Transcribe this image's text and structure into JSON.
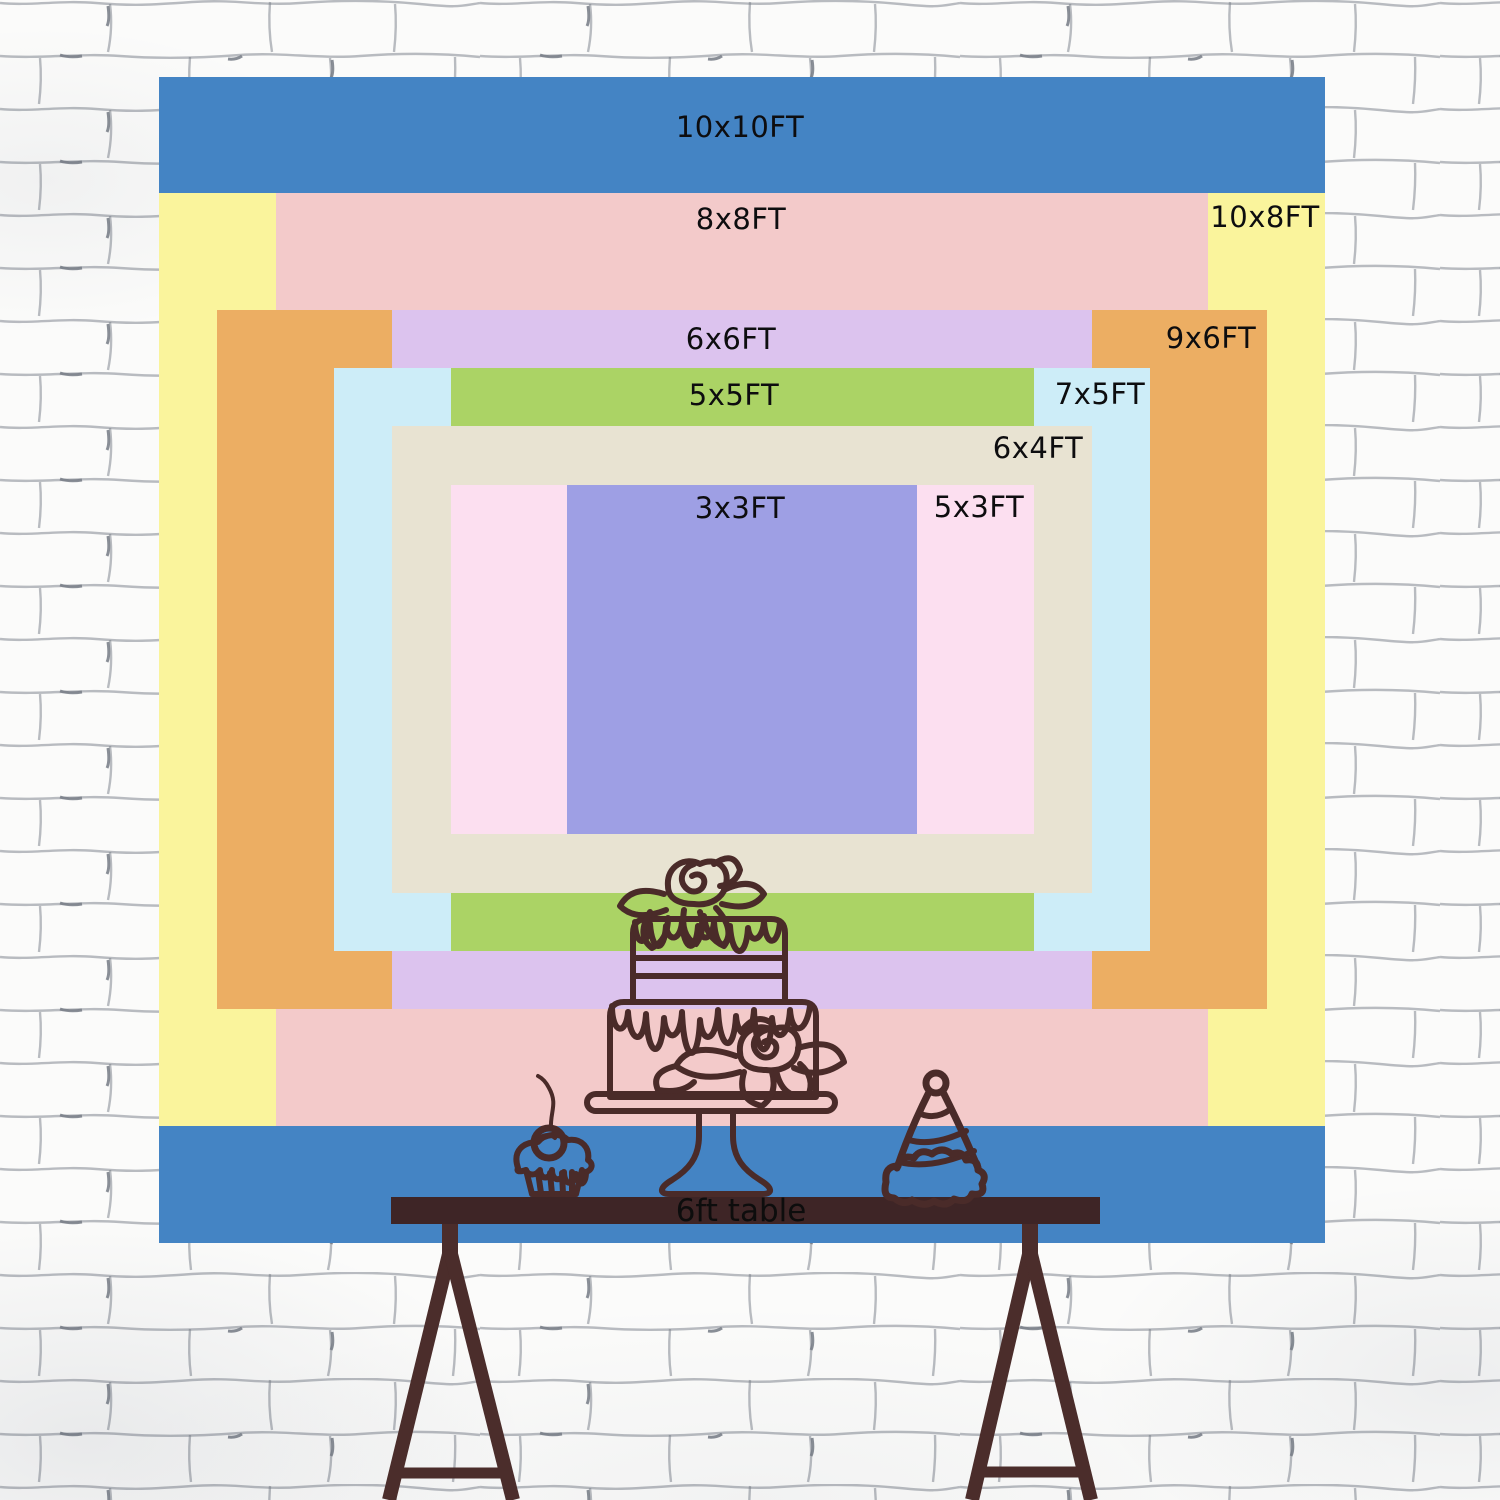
{
  "scene": {
    "wall_color": "#fbfbfa",
    "mortar_color": "#767b85"
  },
  "backdrop": {
    "px_per_ft": 116.6,
    "center_x": 742,
    "center_y": 659.5,
    "label_color": "#0d0d0f",
    "sizes": [
      {
        "label": "10x10FT",
        "w_ft": 10,
        "h_ft": 10,
        "color": "#4484c4",
        "label_x": 740,
        "label_y": 127
      },
      {
        "label": "10x8FT",
        "w_ft": 10,
        "h_ft": 8,
        "color": "#faf49c",
        "label_x": 1265,
        "label_y": 217
      },
      {
        "label": "8x8FT",
        "w_ft": 8,
        "h_ft": 8,
        "color": "#f3caca",
        "label_x": 741,
        "label_y": 219
      },
      {
        "label": "9x6FT",
        "w_ft": 9,
        "h_ft": 6,
        "color": "#ecae63",
        "label_x": 1211,
        "label_y": 338
      },
      {
        "label": "6x6FT",
        "w_ft": 6,
        "h_ft": 6,
        "color": "#dcc3ee",
        "label_x": 731,
        "label_y": 339
      },
      {
        "label": "7x5FT",
        "w_ft": 7,
        "h_ft": 5,
        "color": "#cdedf8",
        "label_x": 1100,
        "label_y": 394
      },
      {
        "label": "5x5FT",
        "w_ft": 5,
        "h_ft": 5,
        "color": "#abd365",
        "label_x": 734,
        "label_y": 395
      },
      {
        "label": "6x4FT",
        "w_ft": 6,
        "h_ft": 4,
        "color": "#e8e3d2",
        "label_x": 1038,
        "label_y": 448
      },
      {
        "label": "5x3FT",
        "w_ft": 5,
        "h_ft": 3,
        "color": "#fcdff0",
        "label_x": 979,
        "label_y": 507
      },
      {
        "label": "3x3FT",
        "w_ft": 3,
        "h_ft": 3,
        "color": "#9e9fe4",
        "label_x": 740,
        "label_y": 508
      }
    ]
  },
  "table": {
    "label": "6ft table",
    "text_color": "#0d0d0d",
    "top_color": "#3e2526",
    "leg_color": "#4b2d2b"
  },
  "illustration": {
    "stroke_color": "#4a2b29",
    "items": [
      "birthday-cake-icon",
      "cupcake-icon",
      "party-hat-icon"
    ]
  }
}
